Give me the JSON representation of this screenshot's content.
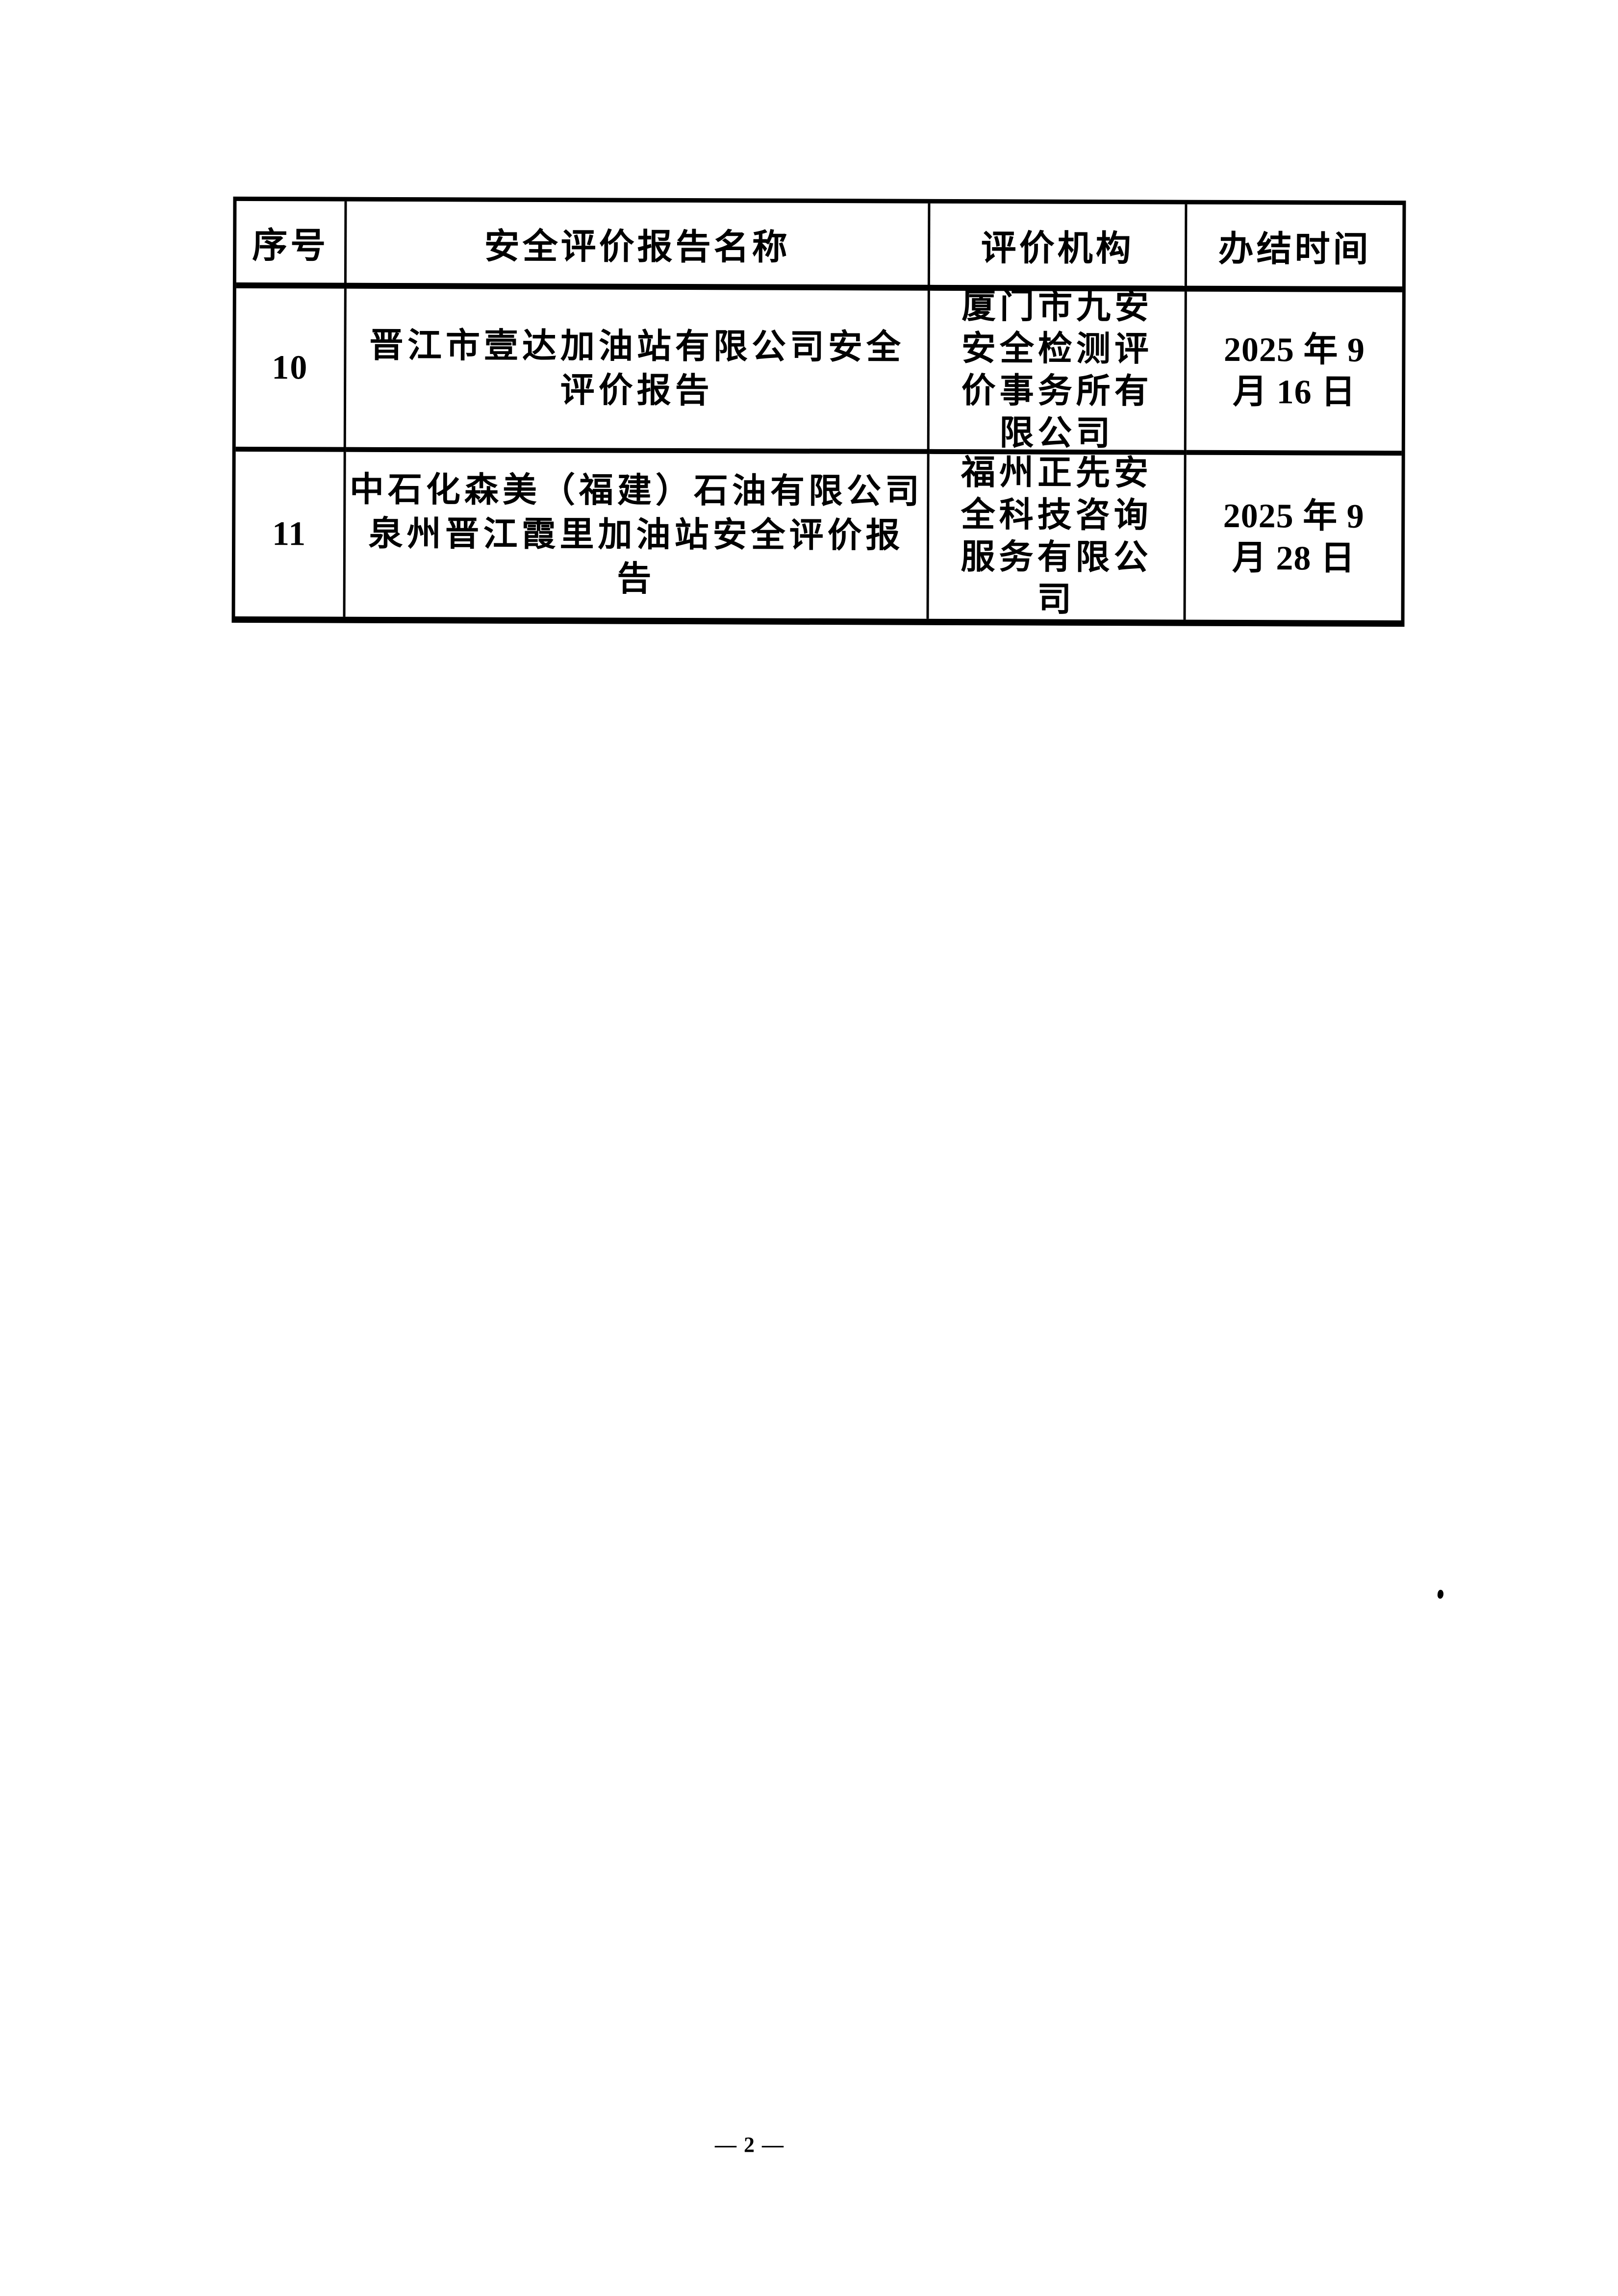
{
  "colors": {
    "ink": "#000000",
    "paper": "#ffffff"
  },
  "page": {
    "number_label": "— 2 —"
  },
  "table": {
    "headers": [
      "序号",
      "安全评价报告名称",
      "评价机构",
      "办结时间"
    ],
    "rows": [
      {
        "index": "10",
        "report": "晋江市壹达加油站有限公司安全\n评价报告",
        "agency": "厦门市九安\n安全检测评\n价事务所有\n限公司",
        "date": "2025 年 9\n月 16 日"
      },
      {
        "index": "11",
        "report": "中石化森美（福建）石油有限公司\n泉州晋江霞里加油站安全评价报\n告",
        "agency": "福州正先安\n全科技咨询\n服务有限公\n司",
        "date": "2025 年 9\n月 28 日"
      }
    ]
  }
}
